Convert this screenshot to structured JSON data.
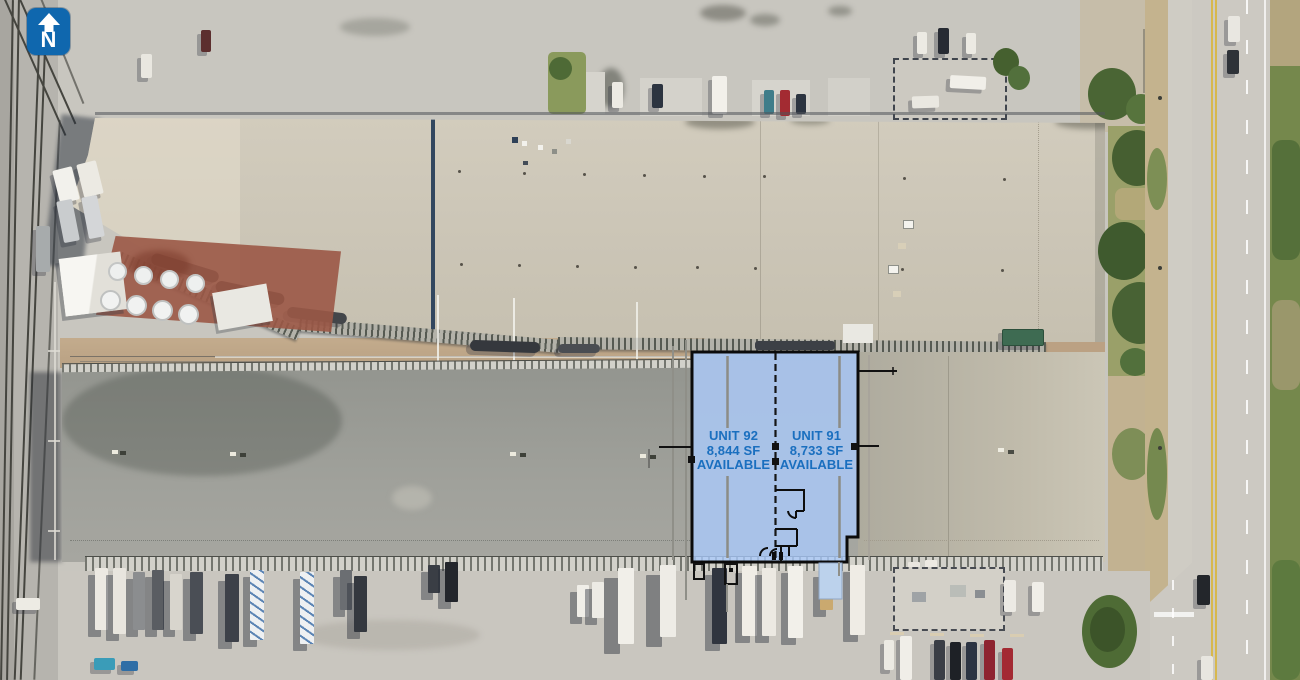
{
  "page": {
    "description": "Aerial site plan of industrial park with leasing availability overlay"
  },
  "north_indicator": {
    "letter": "N",
    "background_color": "#0F67AE",
    "glyph_color": "#FFFFFF"
  },
  "availability_overlay": {
    "fill_color": "#A9C3E8",
    "outline_color": "#0B0B0B",
    "label_color": "#1A6FBF",
    "units": [
      {
        "id": "unit-92",
        "name": "UNIT 92",
        "area": "8,844 SF",
        "status": "AVAILABLE"
      },
      {
        "id": "unit-91",
        "name": "UNIT 91",
        "area": "8,733 SF",
        "status": "AVAILABLE"
      }
    ]
  }
}
